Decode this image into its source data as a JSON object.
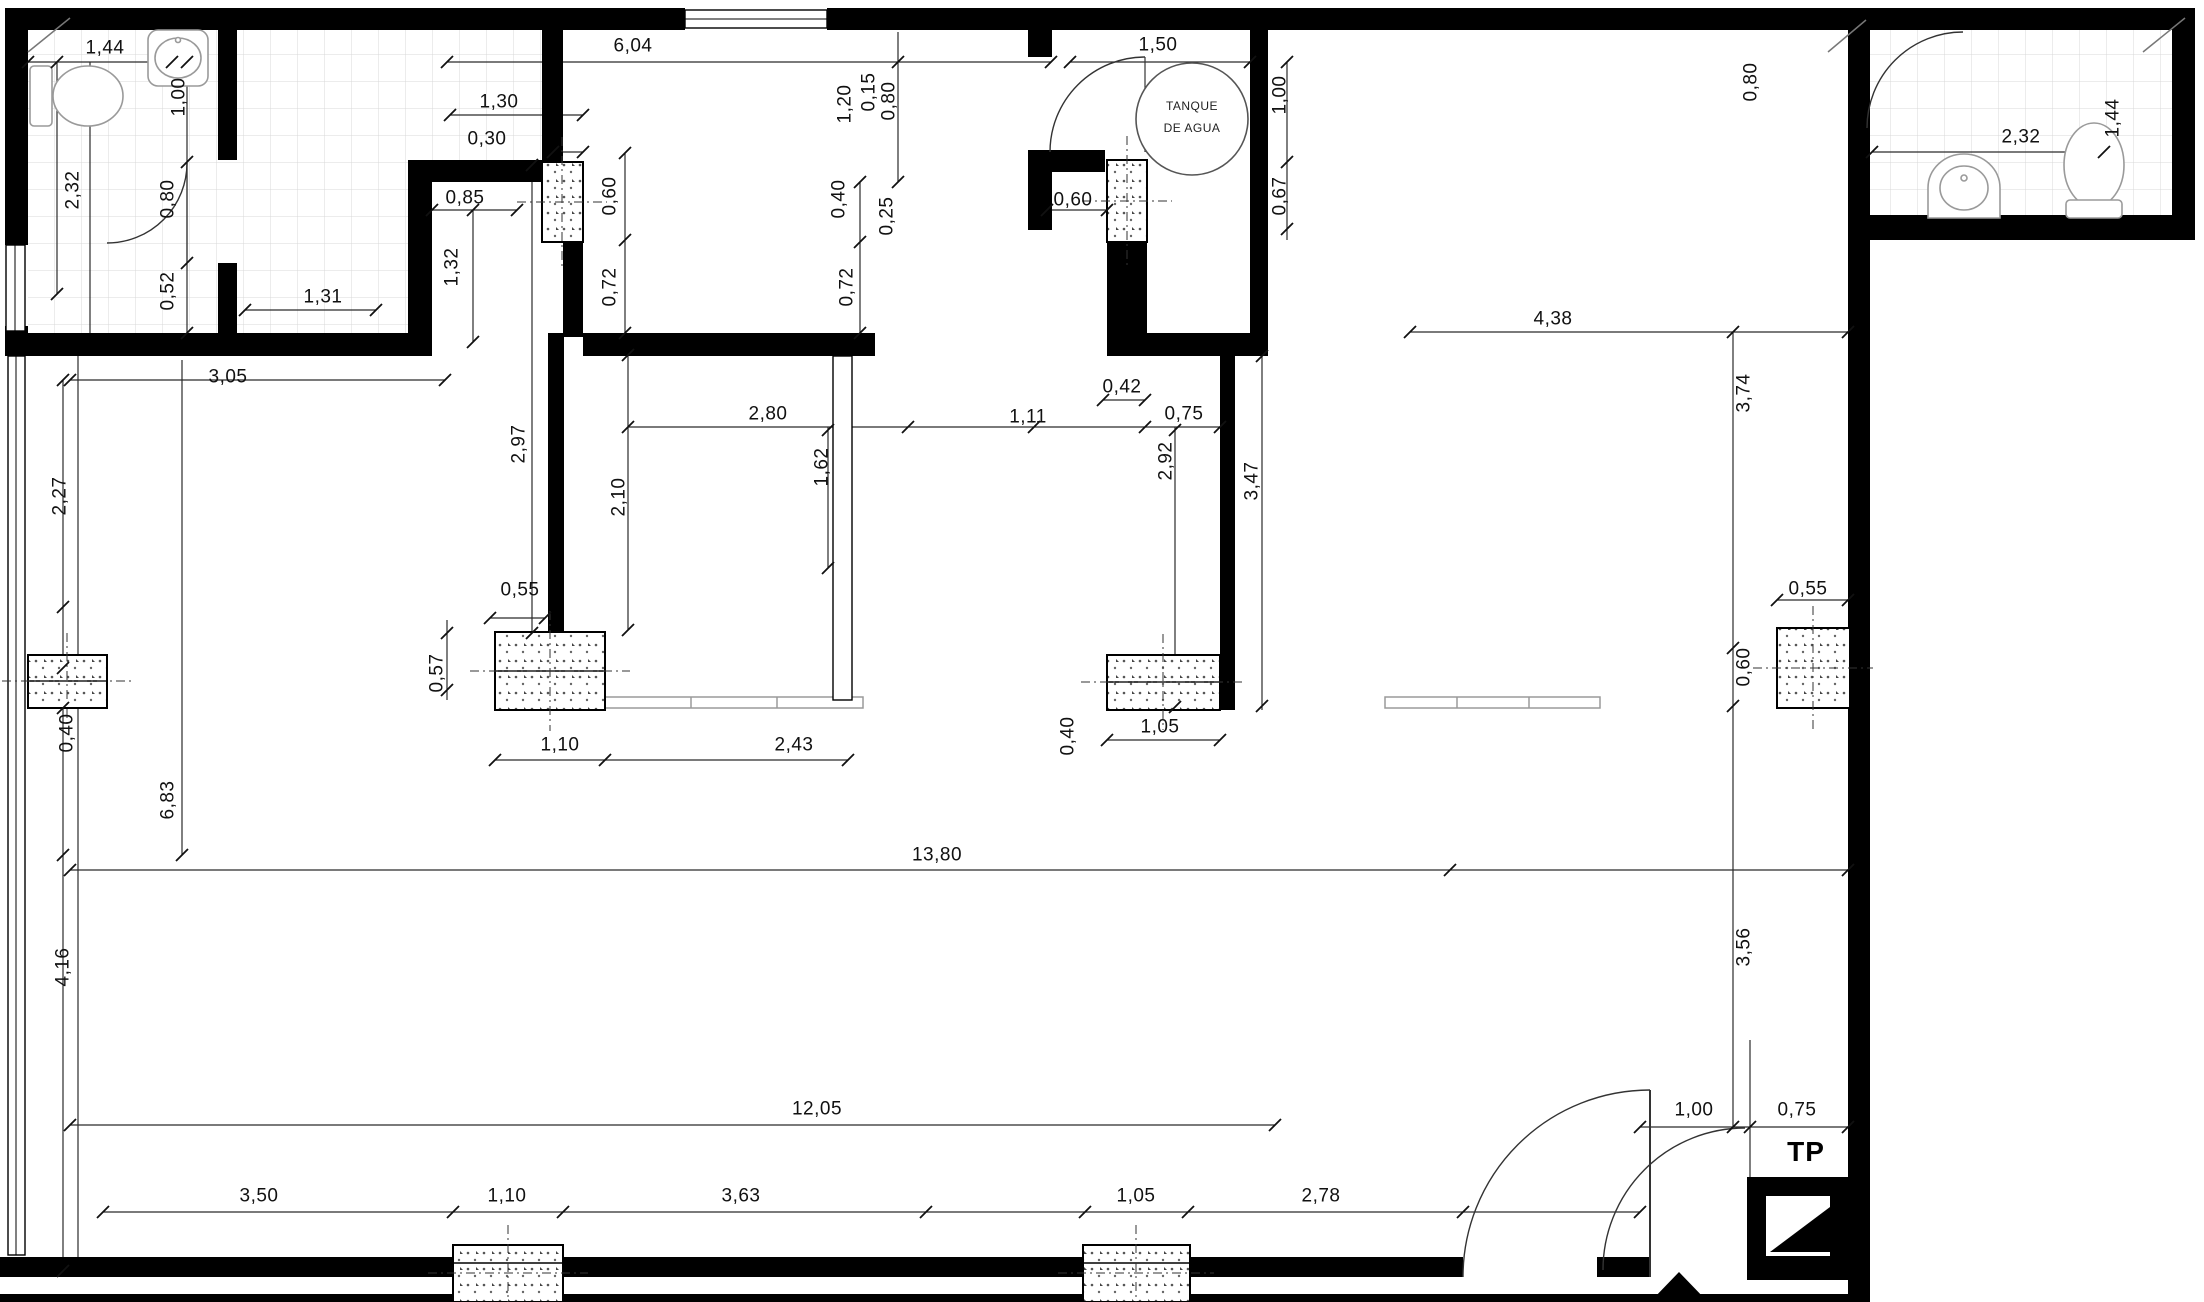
{
  "drawing": {
    "type": "architectural-floor-plan",
    "room_texts": {
      "tank_line1": "TANQUE",
      "tank_line2": "DE AGUA",
      "shaft": "TP"
    },
    "wall_color": "#000000",
    "line_color": "#2b2b2b",
    "tile_color": "#d9d9d9"
  },
  "dimension_labels": [
    {
      "text": "1,44",
      "x": 105,
      "y": 48,
      "o": "h"
    },
    {
      "text": "1,00",
      "x": 179,
      "y": 97,
      "o": "v"
    },
    {
      "text": "2,32",
      "x": 73,
      "y": 190,
      "o": "v"
    },
    {
      "text": "0,80",
      "x": 168,
      "y": 199,
      "o": "v"
    },
    {
      "text": "0,52",
      "x": 168,
      "y": 291,
      "o": "v"
    },
    {
      "text": "1,31",
      "x": 323,
      "y": 297,
      "o": "h"
    },
    {
      "text": "1,32",
      "x": 452,
      "y": 267,
      "o": "v"
    },
    {
      "text": "6,04",
      "x": 633,
      "y": 46,
      "o": "h"
    },
    {
      "text": "1,30",
      "x": 499,
      "y": 102,
      "o": "h"
    },
    {
      "text": "0,30",
      "x": 487,
      "y": 139,
      "o": "h"
    },
    {
      "text": "0,85",
      "x": 465,
      "y": 198,
      "o": "h"
    },
    {
      "text": "0,60",
      "x": 610,
      "y": 196,
      "o": "v"
    },
    {
      "text": "0,72",
      "x": 610,
      "y": 287,
      "o": "v"
    },
    {
      "text": "2,97",
      "x": 519,
      "y": 444,
      "o": "v"
    },
    {
      "text": "2,10",
      "x": 619,
      "y": 497,
      "o": "v"
    },
    {
      "text": "3,05",
      "x": 228,
      "y": 377,
      "o": "h"
    },
    {
      "text": "2,27",
      "x": 60,
      "y": 496,
      "o": "v"
    },
    {
      "text": "1,20",
      "x": 845,
      "y": 104,
      "o": "v"
    },
    {
      "text": "0,15",
      "x": 869,
      "y": 92,
      "o": "v"
    },
    {
      "text": "0,80",
      "x": 889,
      "y": 101,
      "o": "v"
    },
    {
      "text": "0,40",
      "x": 839,
      "y": 199,
      "o": "v"
    },
    {
      "text": "0,25",
      "x": 887,
      "y": 216,
      "o": "v"
    },
    {
      "text": "0,72",
      "x": 847,
      "y": 287,
      "o": "v"
    },
    {
      "text": "1,50",
      "x": 1158,
      "y": 45,
      "o": "h"
    },
    {
      "text": "0,60",
      "x": 1073,
      "y": 200,
      "o": "h"
    },
    {
      "text": "1,00",
      "x": 1280,
      "y": 95,
      "o": "v"
    },
    {
      "text": "0,67",
      "x": 1280,
      "y": 196,
      "o": "v"
    },
    {
      "text": "0,42",
      "x": 1122,
      "y": 387,
      "o": "h"
    },
    {
      "text": "2,80",
      "x": 768,
      "y": 414,
      "o": "h"
    },
    {
      "text": "1,11",
      "x": 1028,
      "y": 417,
      "o": "h"
    },
    {
      "text": "0,75",
      "x": 1184,
      "y": 414,
      "o": "h"
    },
    {
      "text": "1,62",
      "x": 822,
      "y": 467,
      "o": "v"
    },
    {
      "text": "2,92",
      "x": 1166,
      "y": 461,
      "o": "v"
    },
    {
      "text": "3,47",
      "x": 1252,
      "y": 481,
      "o": "v"
    },
    {
      "text": "4,38",
      "x": 1553,
      "y": 319,
      "o": "h"
    },
    {
      "text": "3,74",
      "x": 1744,
      "y": 393,
      "o": "v"
    },
    {
      "text": "0,80",
      "x": 1751,
      "y": 82,
      "o": "v"
    },
    {
      "text": "2,32",
      "x": 2021,
      "y": 137,
      "o": "h"
    },
    {
      "text": "1,44",
      "x": 2113,
      "y": 118,
      "o": "v"
    },
    {
      "text": "0,55",
      "x": 520,
      "y": 590,
      "o": "h"
    },
    {
      "text": "0,57",
      "x": 437,
      "y": 673,
      "o": "v"
    },
    {
      "text": "1,10",
      "x": 560,
      "y": 745,
      "o": "h"
    },
    {
      "text": "2,43",
      "x": 794,
      "y": 745,
      "o": "h"
    },
    {
      "text": "0,40",
      "x": 67,
      "y": 733,
      "o": "v"
    },
    {
      "text": "0,40",
      "x": 1068,
      "y": 736,
      "o": "v"
    },
    {
      "text": "1,05",
      "x": 1160,
      "y": 727,
      "o": "h"
    },
    {
      "text": "0,55",
      "x": 1808,
      "y": 589,
      "o": "h"
    },
    {
      "text": "0,60",
      "x": 1744,
      "y": 667,
      "o": "v"
    },
    {
      "text": "6,83",
      "x": 168,
      "y": 800,
      "o": "v"
    },
    {
      "text": "13,80",
      "x": 937,
      "y": 855,
      "o": "h"
    },
    {
      "text": "4,16",
      "x": 63,
      "y": 967,
      "o": "v"
    },
    {
      "text": "3,56",
      "x": 1744,
      "y": 947,
      "o": "v"
    },
    {
      "text": "12,05",
      "x": 817,
      "y": 1109,
      "o": "h"
    },
    {
      "text": "1,00",
      "x": 1694,
      "y": 1110,
      "o": "h"
    },
    {
      "text": "0,75",
      "x": 1797,
      "y": 1110,
      "o": "h"
    },
    {
      "text": "3,50",
      "x": 259,
      "y": 1196,
      "o": "h"
    },
    {
      "text": "1,10",
      "x": 507,
      "y": 1196,
      "o": "h"
    },
    {
      "text": "3,63",
      "x": 741,
      "y": 1196,
      "o": "h"
    },
    {
      "text": "1,05",
      "x": 1136,
      "y": 1196,
      "o": "h"
    },
    {
      "text": "2,78",
      "x": 1321,
      "y": 1196,
      "o": "h"
    }
  ]
}
